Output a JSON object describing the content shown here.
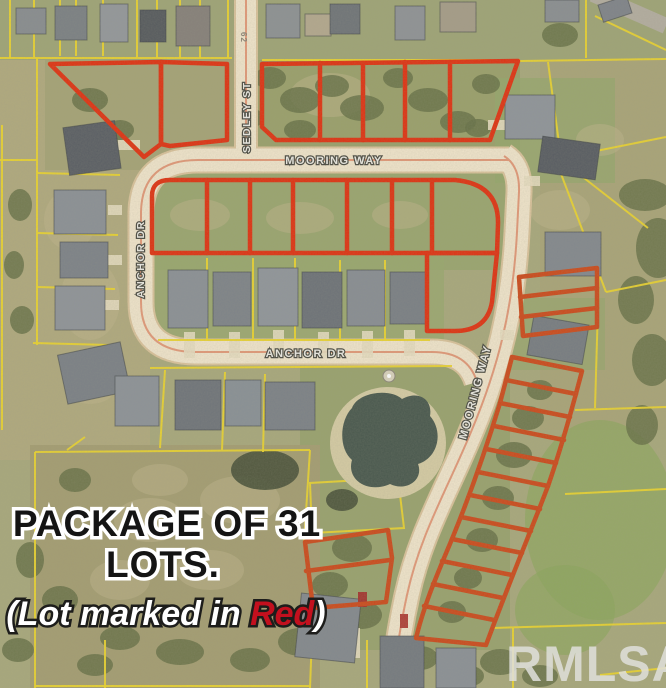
{
  "title": "Aerial plat map of subdivision lot package",
  "streets": {
    "sedley_st": "SEDLEY ST",
    "mooring_way_top": "MOORING WAY",
    "anchor_dr_west": "ANCHOR DR",
    "anchor_dr_south": "ANCHOR DR",
    "mooring_way_east": "MOORING WAY"
  },
  "pavement_marking": "62",
  "overlay": {
    "line1": "PACKAGE OF 31",
    "line2": "LOTS.",
    "line3_prefix": "(Lot marked in ",
    "line3_highlight": "Red",
    "line3_suffix": ")"
  },
  "watermark": "RMLSA",
  "colors": {
    "lot_outline_red": "#e03212",
    "lot_outline_rust": "#cc4a1c",
    "parcel_line_yellow": "#ead32f",
    "road_surface": "#f0e4cb",
    "road_centerline": "#e09070",
    "field_base": "#a8a87c",
    "tree_olive": "#667047",
    "pond_water": "#49584e",
    "pond_beach": "#d5cba4",
    "overlay_text_fill": "#141414",
    "overlay_text_outline": "#ffffff",
    "overlay_red_word": "#c3101e",
    "watermark_gray": "#e0e0dc"
  }
}
